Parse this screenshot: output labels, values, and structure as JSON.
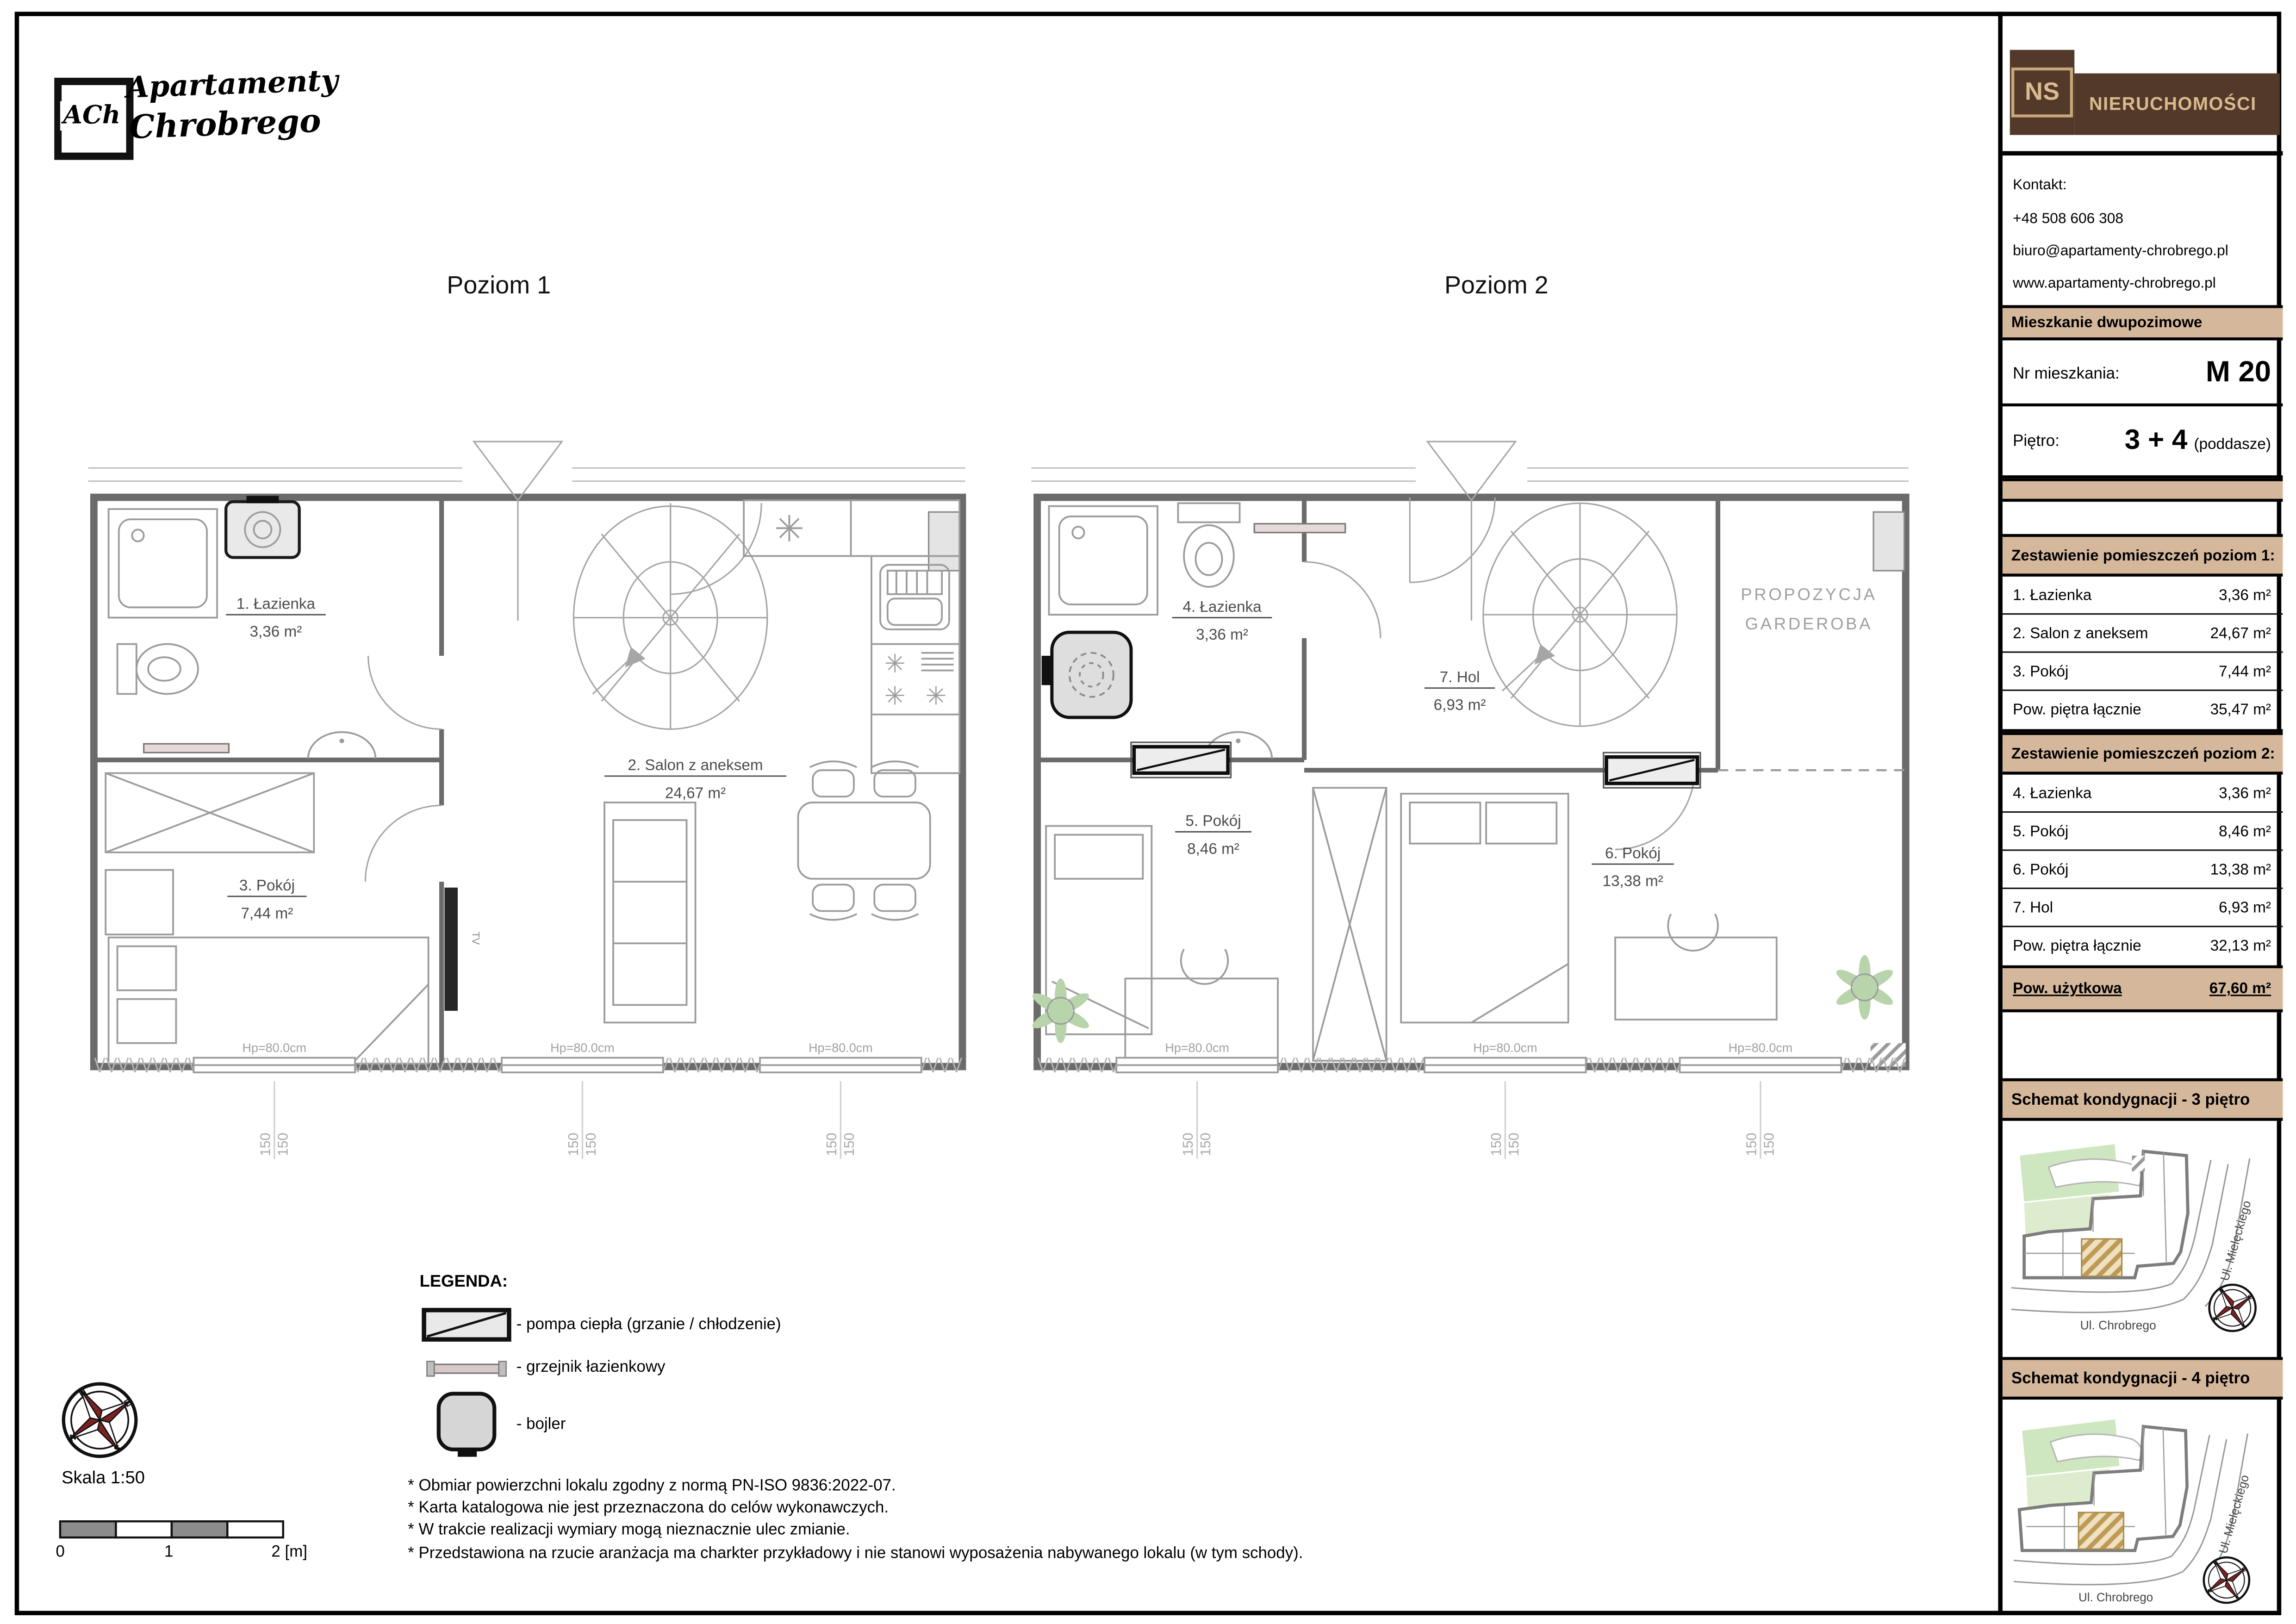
{
  "header": {
    "logo_badge": "ACh",
    "logo_line1": "Apartamenty",
    "logo_line2": "Chrobrego"
  },
  "plan1": {
    "title": "Poziom 1",
    "rooms": {
      "r1": {
        "name": "1. Łazienka",
        "area": "3,36 m²"
      },
      "r2": {
        "name": "2. Salon z aneksem",
        "area": "24,67 m²"
      },
      "r3": {
        "name": "3. Pokój",
        "area": "7,44 m²"
      }
    },
    "tv": "TV",
    "window_label": "Hp=80.0cm",
    "dim": "150"
  },
  "plan2": {
    "title": "Poziom 2",
    "rooms": {
      "r4": {
        "name": "4. Łazienka",
        "area": "3,36 m²"
      },
      "r5": {
        "name": "5. Pokój",
        "area": "8,46 m²"
      },
      "r6": {
        "name": "6. Pokój",
        "area": "13,38 m²"
      },
      "r7": {
        "name": "7. Hol",
        "area": "6,93 m²"
      }
    },
    "wardrobe_note_line1": "PROPOZYCJA",
    "wardrobe_note_line2": "GARDEROBA",
    "window_label": "Hp=80.0cm",
    "dim": "150"
  },
  "legend": {
    "title": "LEGENDA:",
    "items": [
      {
        "label": "- pompa ciepła (grzanie / chłodzenie)"
      },
      {
        "label": "- grzejnik łazienkowy"
      },
      {
        "label": "- bojler"
      }
    ]
  },
  "notes": [
    "* Obmiar powierzchni lokalu zgodny z normą PN-ISO 9836:2022-07.",
    "* Karta katalogowa nie jest przeznaczona do celów wykonawczych.",
    "* W trakcie realizacji wymiary mogą nieznacznie ulec zmianie.",
    "* Przedstawiona na rzucie aranżacja ma charkter przykładowy i nie stanowi wyposażenia nabywanego lokalu (w tym schody)."
  ],
  "scale": {
    "label": "Skala 1:50",
    "tick0": "0",
    "tick1": "1",
    "tick2": "2 [m]"
  },
  "compass": {
    "n": "N",
    "e": "E",
    "s": "S",
    "w": "W"
  },
  "sidebar": {
    "brand": {
      "ns": "NS",
      "name": "NIERUCHOMOŚCI"
    },
    "contact": {
      "heading": "Kontakt:",
      "phone": "+48 508 606 308",
      "email": "biuro@apartamenty-chrobrego.pl",
      "website": "www.apartamenty-chrobrego.pl"
    },
    "type_banner": "Mieszkanie dwupozimowe",
    "apartment": {
      "number_label": "Nr mieszkania:",
      "number": "M 20",
      "floor_label": "Piętro:",
      "floor": "3 + 4",
      "floor_suffix": "(poddasze)"
    },
    "level1_table": {
      "header": "Zestawienie pomieszczeń poziom 1:",
      "rows": [
        {
          "label": "1. Łazienka",
          "value": "3,36 m²"
        },
        {
          "label": "2. Salon z aneksem",
          "value": "24,67 m²"
        },
        {
          "label": "3. Pokój",
          "value": "7,44 m²"
        }
      ],
      "total_label": "Pow. piętra łącznie",
      "total_value": "35,47 m²"
    },
    "level2_table": {
      "header": "Zestawienie pomieszczeń poziom 2:",
      "rows": [
        {
          "label": "4. Łazienka",
          "value": "3,36 m²"
        },
        {
          "label": "5. Pokój",
          "value": "8,46 m²"
        },
        {
          "label": "6. Pokój",
          "value": "13,38 m²"
        },
        {
          "label": "7. Hol",
          "value": "6,93 m²"
        }
      ],
      "total_label": "Pow. piętra łącznie",
      "total_value": "32,13 m²"
    },
    "usable_area": {
      "label": "Pow. użytkowa",
      "value": "67,60 m²"
    },
    "schematic1": {
      "header": "Schemat kondygnacji - 3 piętro",
      "street_bottom": "Ul. Chrobrego",
      "street_right": "Ul. Mielęckiego"
    },
    "schematic2": {
      "header": "Schemat kondygnacji - 4 piętro",
      "street_bottom": "Ul. Chrobrego",
      "street_right": "Ul. Mielęckiego"
    }
  },
  "colors": {
    "tan": "#d5b89c",
    "brown": "#53392a",
    "brown_text": "#d9bb8e",
    "green": "#cfe7c0",
    "wall": "#6b6b6b",
    "dark_red": "#7b2222"
  }
}
